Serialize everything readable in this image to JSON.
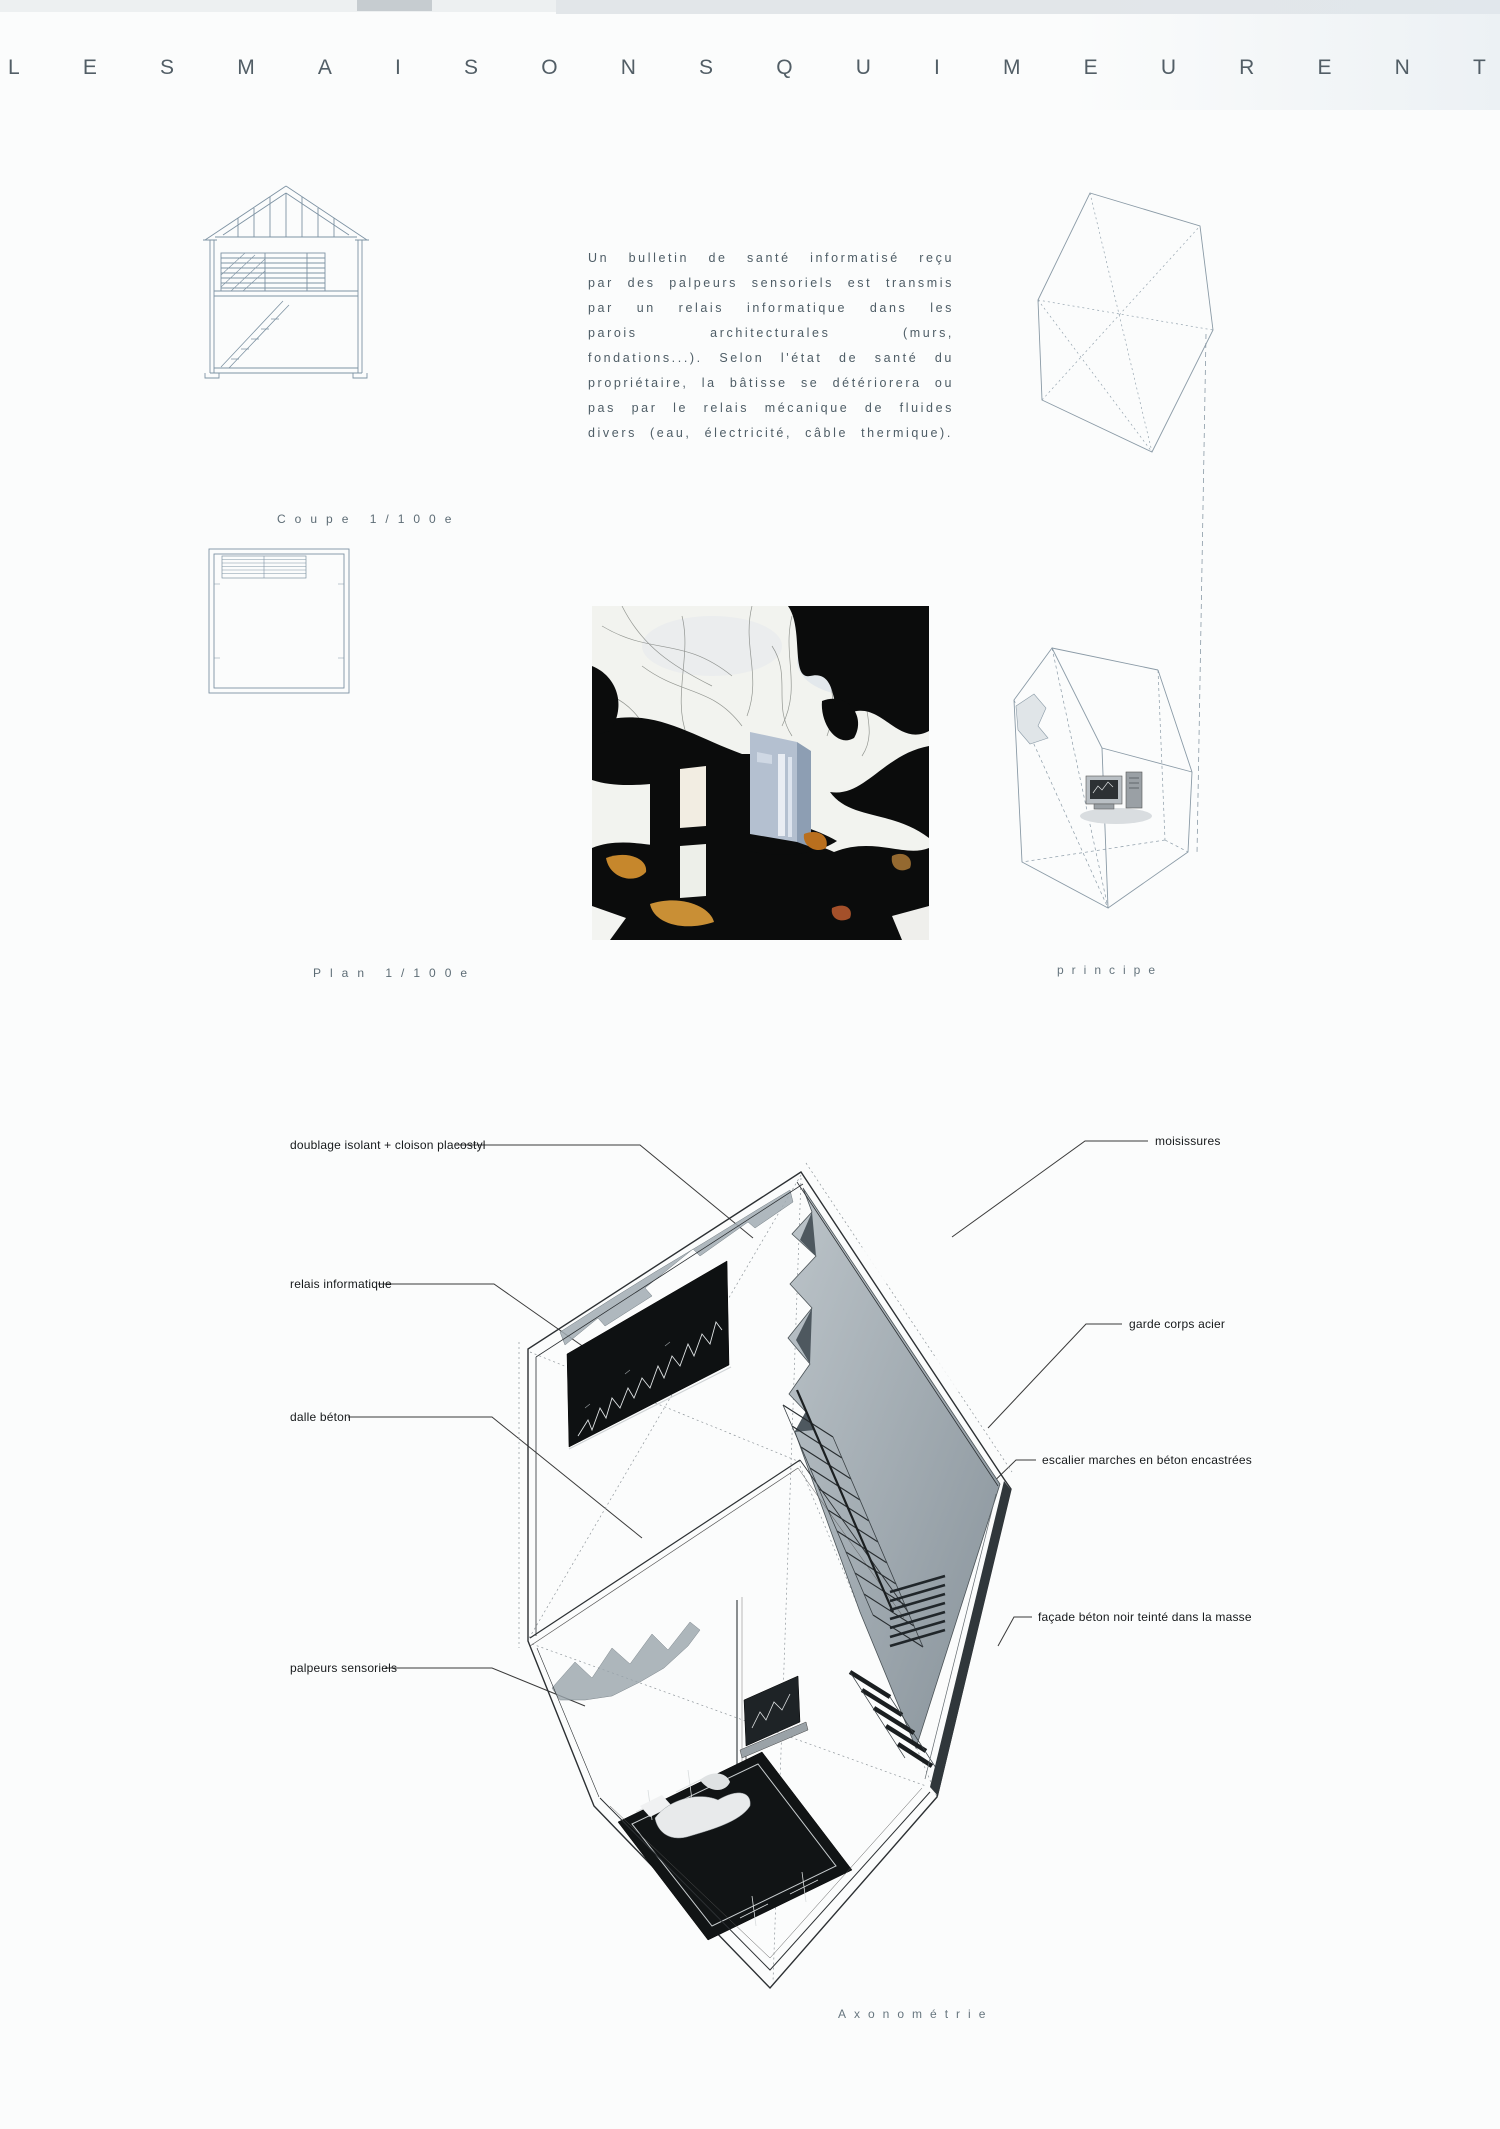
{
  "board": {
    "title": "LES MAISONS QUI MEURENT",
    "title_letters": "LESMAISONSQUIMEURENT"
  },
  "intro_text": "Un bulletin de santé informatisé reçu par des palpeurs sensoriels est transmis par un relais informatique dans les parois architecturales (murs, fondations...). Selon l'état de santé du propriétaire, la bâtisse se détériorera ou pas par le relais mécanique de fluides divers (eau, électricité, câble thermique).",
  "captions": {
    "coupe": "Coupe 1/100e",
    "plan": "Plan 1/100e",
    "principe": "principe",
    "axonometrie": "Axonométrie"
  },
  "axon_labels": {
    "left": [
      "doublage isolant + cloison placostyl",
      "relais informatique",
      "dalle béton",
      "palpeurs sensoriels"
    ],
    "right": [
      "moisissures",
      "garde corps acier",
      "escalier marches en béton encastrées",
      "façade béton noir teinté dans la masse"
    ]
  },
  "colors": {
    "drawing_ink_blue": "#7e93a3",
    "title_ink": "#525e66",
    "caption_ink": "#5d6c75",
    "label_ink": "#16191b",
    "roof_grey": "#9aa4ab",
    "screen_black": "#0e1112",
    "photo_amber": "#c6872c"
  }
}
